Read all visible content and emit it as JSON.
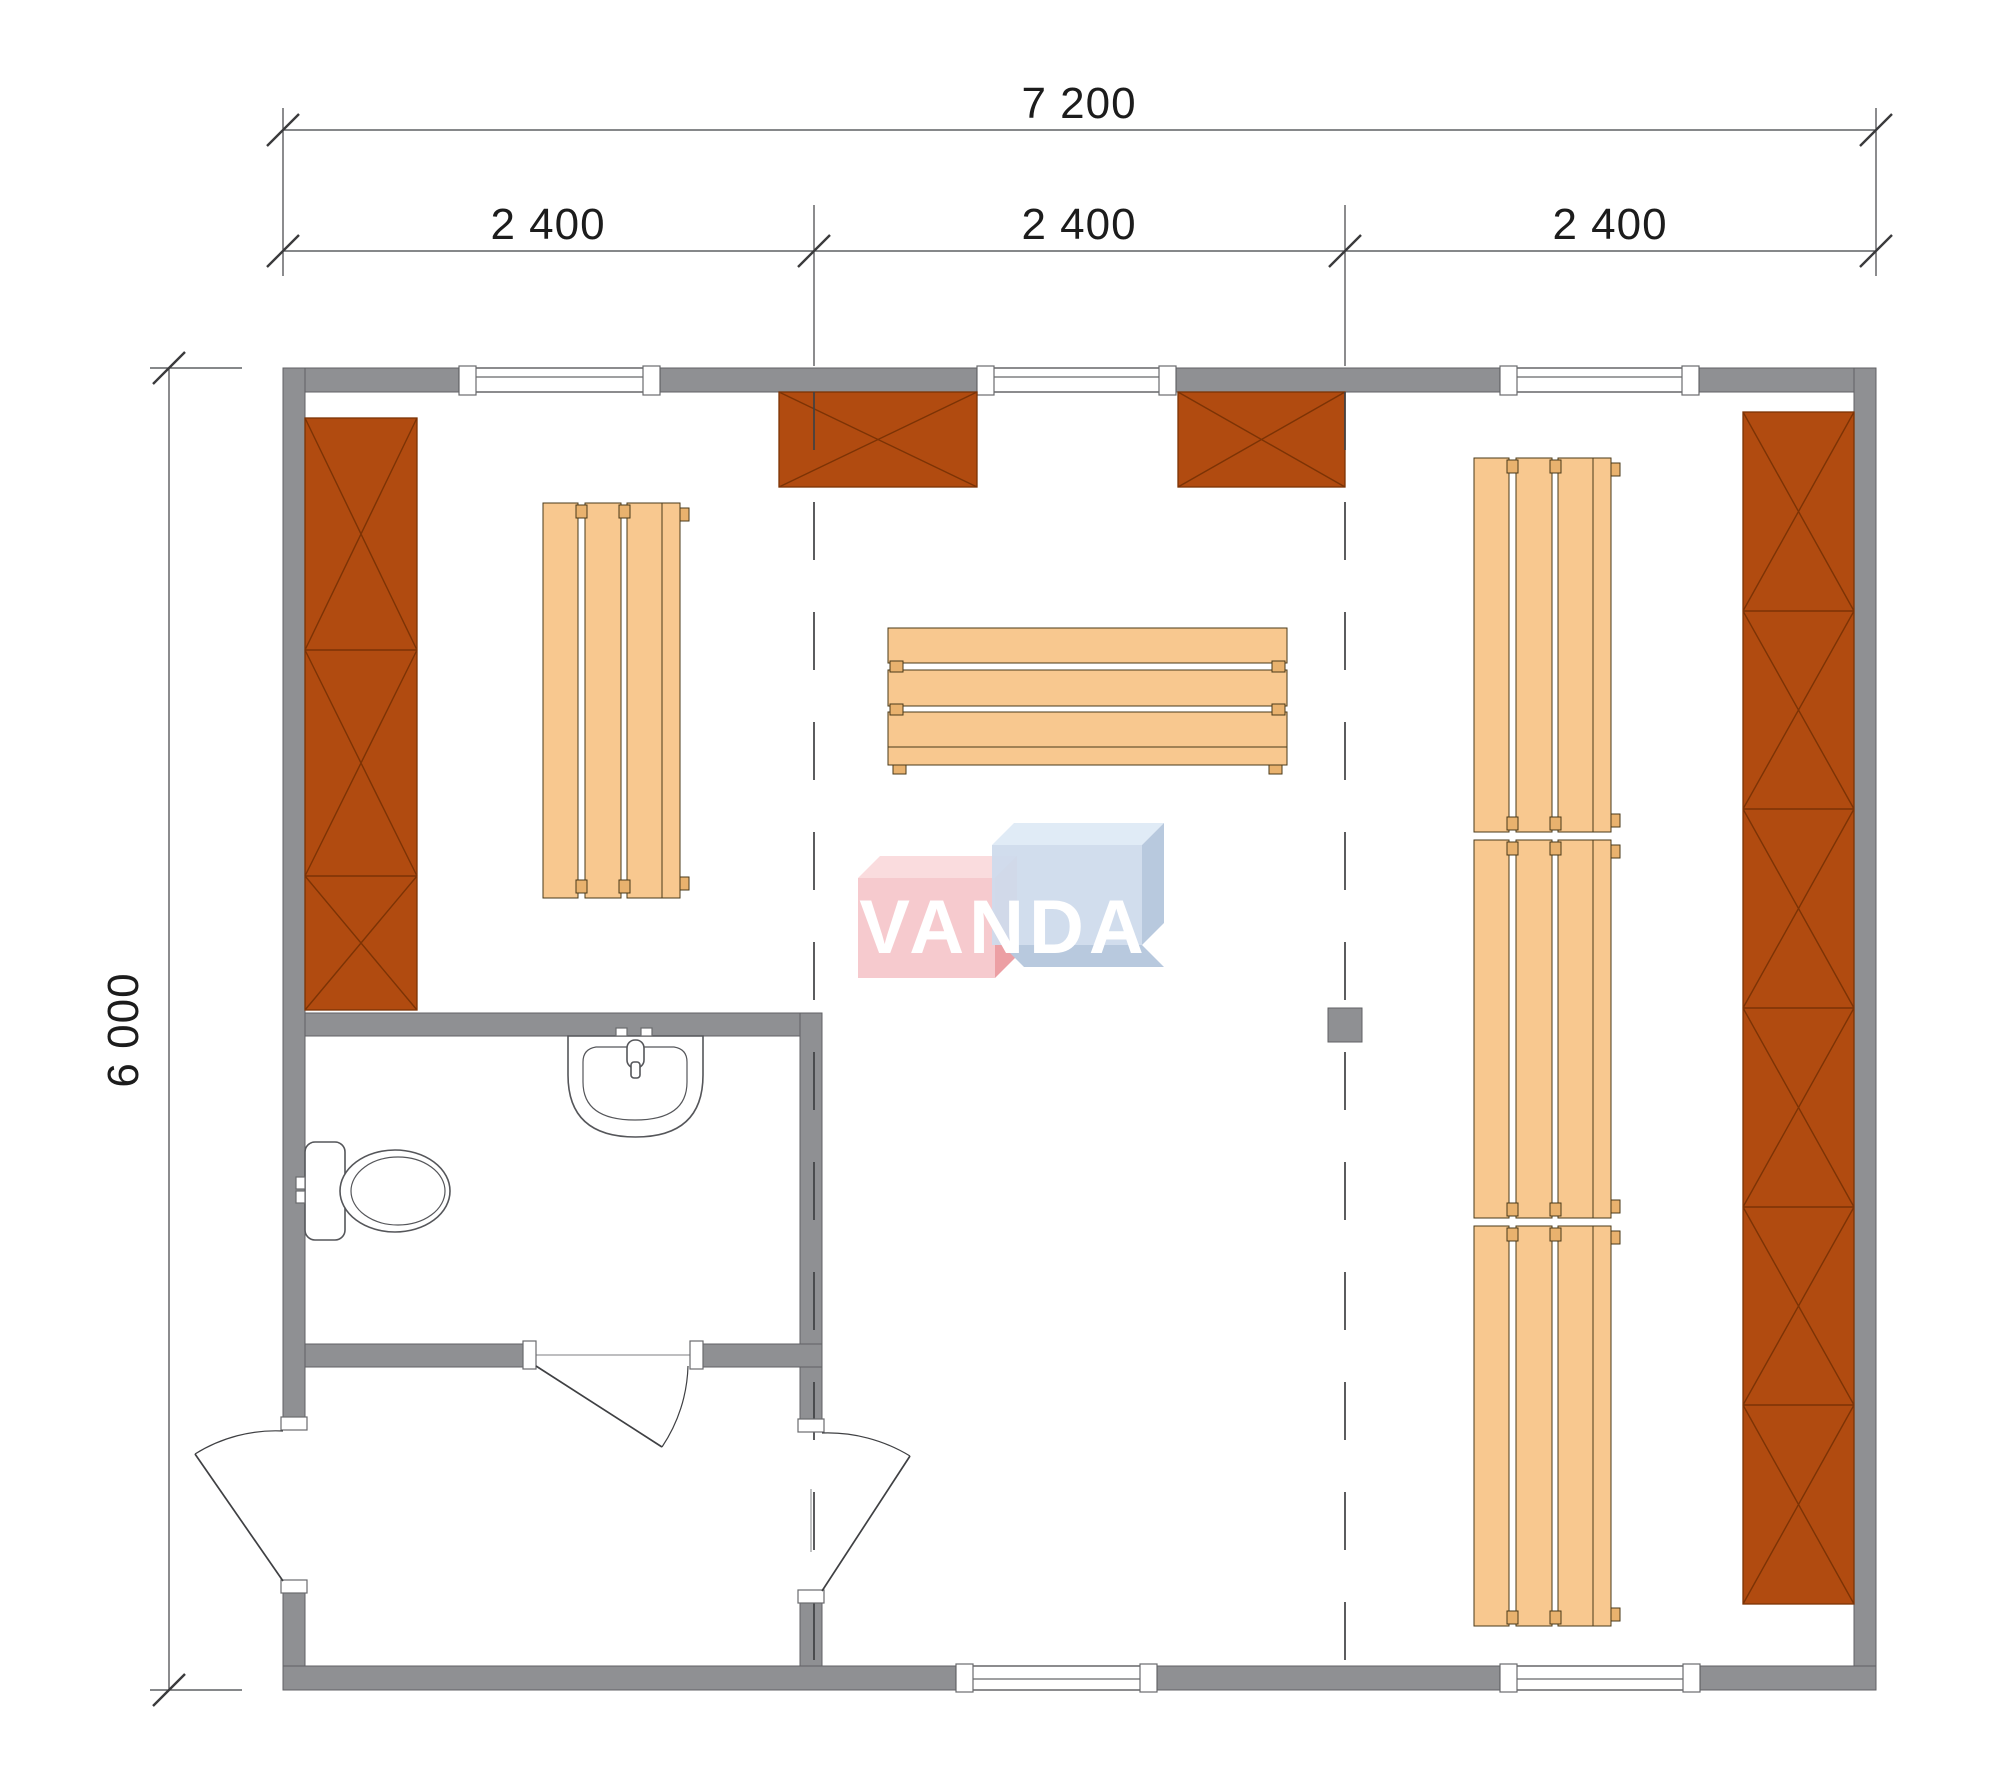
{
  "dims": {
    "total_width": "7 200",
    "modules": [
      "2 400",
      "2 400",
      "2 400"
    ],
    "total_height": "6 000"
  },
  "watermark": {
    "text": "VANDA"
  },
  "plan_elements": {
    "rooms": [
      "main-room",
      "bathroom",
      "vestibule"
    ],
    "fixtures": [
      "toilet",
      "sink"
    ],
    "furniture": [
      "wall-cabinet-left",
      "overhead-cabinet-1",
      "overhead-cabinet-2",
      "wall-cabinet-right",
      "slat-bench-left",
      "slat-bench-center",
      "slat-bench-right"
    ],
    "openings": [
      "window-top-1",
      "window-top-2",
      "window-top-3",
      "window-bottom-1",
      "window-bottom-2",
      "door-entrance",
      "door-interior",
      "door-bathroom"
    ]
  },
  "colors": {
    "bg": "#ffffff",
    "wall_gray": "#8f9093",
    "wall_edge": "#606165",
    "line": "#3f4043",
    "dim_text": "#1c1c1c",
    "brown": "#b14b10",
    "brown_dark": "#7c3305",
    "wood": "#f8c88f",
    "wood_tab": "#e9b26e",
    "wood_edge": "#4a3a1a",
    "fixture_line": "#55565a",
    "logo_pink": "#f6c5c9",
    "logo_pink_top": "#fadbdd",
    "logo_pink_side": "#ec9aa0",
    "logo_blue": "#cddaeb",
    "logo_blue_top": "#dfeaf6",
    "logo_blue_side": "#b5c7dd",
    "logo_text": "#ffffff"
  }
}
